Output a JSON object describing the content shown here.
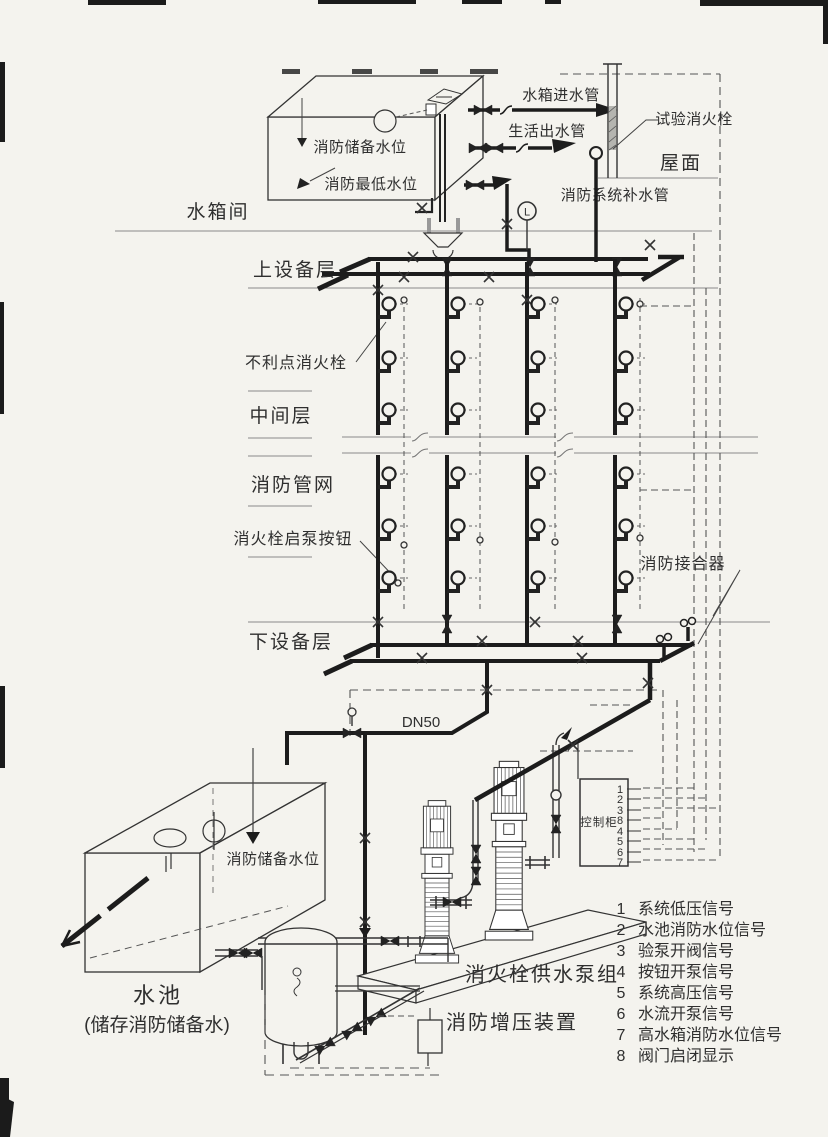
{
  "colors": {
    "pipe": "#1c1c1c",
    "line": "#333333",
    "floor": "#8a8a8a",
    "signal": "#555555",
    "text": "#2f2f2f",
    "background": "#f4f3ee"
  },
  "upper_tank": {
    "reserve_level": "消防储备水位",
    "lowest_level": "消防最低水位",
    "inlet_pipe": "水箱进水管",
    "domestic_outlet": "生活出水管",
    "makeup_pipe": "消防系统补水管",
    "gauge": "L"
  },
  "floors": {
    "tank_room": "水箱间",
    "roof": "屋面",
    "upper_equipment": "上设备层",
    "middle": "中间层",
    "lower_equipment": "下设备层"
  },
  "network": {
    "test_hydrant": "试验消火栓",
    "unfavorable_hydrant": "不利点消火栓",
    "pipe_network": "消防管网",
    "pump_button": "消火栓启泵按钮",
    "siamese_connection": "消防接合器",
    "dn50": "DN50"
  },
  "pump_room": {
    "control_cabinet": "控制柜",
    "ports": [
      "1",
      "2",
      "3",
      "8",
      "4",
      "5",
      "6",
      "7"
    ],
    "pump_group": "消火栓供水泵组",
    "pressurization": "消防增压装置",
    "pool": "水池",
    "pool_note": "(储存消防储备水)",
    "pool_level": "消防储备水位"
  },
  "legend": {
    "items": [
      {
        "num": "1",
        "text": "系统低压信号"
      },
      {
        "num": "2",
        "text": "水池消防水位信号"
      },
      {
        "num": "3",
        "text": "验泵开阀信号"
      },
      {
        "num": "4",
        "text": "按钮开泵信号"
      },
      {
        "num": "5",
        "text": "系统高压信号"
      },
      {
        "num": "6",
        "text": "水流开泵信号"
      },
      {
        "num": "7",
        "text": "高水箱消防水位信号"
      },
      {
        "num": "8",
        "text": "阀门启闭显示"
      }
    ]
  }
}
